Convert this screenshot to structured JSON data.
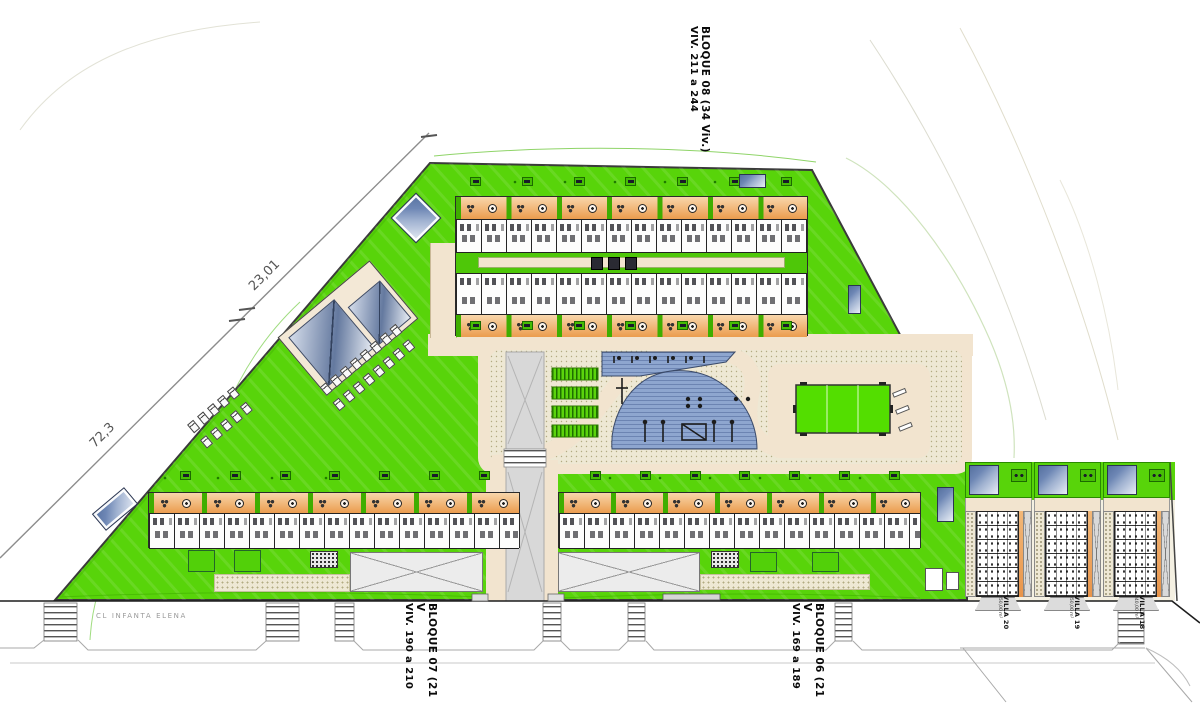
{
  "plan": {
    "blocks": {
      "bloque08": {
        "label_line1": "BLOQUE 08 (34 Viv.)",
        "label_line2": "VIV. 211 a 244"
      },
      "bloque07": {
        "label_line1": "BLOQUE 07 (21 V",
        "label_line2": "VIV. 190 a 210"
      },
      "bloque06": {
        "label_line1": "BLOQUE 06 (21 V",
        "label_line2": "VIV. 169 a 189"
      }
    },
    "villas": [
      {
        "name": "VILLA 20",
        "area": "350,00 m²"
      },
      {
        "name": "VILLA 19",
        "area": "350,00 m²"
      },
      {
        "name": "VILLA 18",
        "area": "340,00 m²"
      }
    ],
    "street": {
      "name": "CL INFANTA ELENA"
    },
    "dimensions": {
      "upper": "23,01",
      "lower": "72,3"
    },
    "colors": {
      "lawn": "#58d40a",
      "terrace": "#f2b879",
      "terrace_light": "#f8d6ab",
      "deck": "#8ea6cf",
      "deck_stripe": "#6c84b2",
      "field": "#53de00",
      "path": "#f2e4cf",
      "stipple": "#eee8d4",
      "road": "#d8d8d8",
      "pool_dark": "#6e87b5",
      "pool_light": "#e9eef6",
      "divider_green": "#3fae00"
    },
    "counts": {
      "icon_groups_b08": 7,
      "icon_groups_b07": 7,
      "icon_groups_b06": 7,
      "planter_groups": 7,
      "lounger_rows_a": 2,
      "lounger_cols_a": 8,
      "lounger_rows_b": 2,
      "lounger_cols_b": 5
    }
  }
}
